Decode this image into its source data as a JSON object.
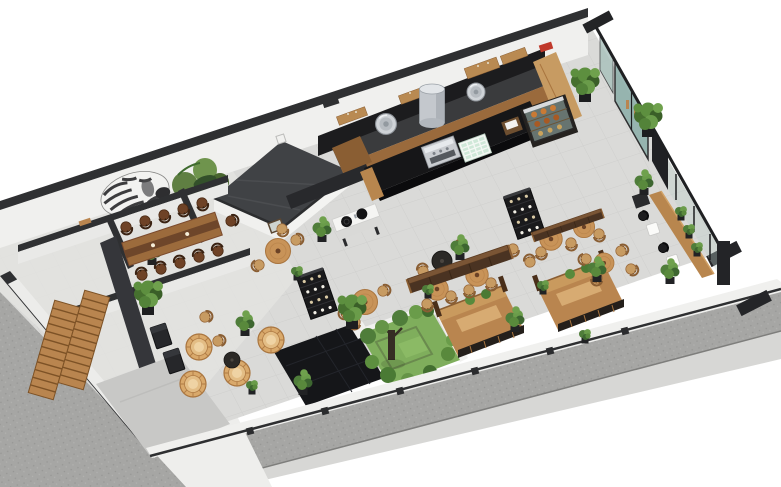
{
  "meta": {
    "title": "3D isometric floor-plan render of a cafe restaurant interior with kitchen, bar, dining hall, booths and street sidewalk"
  },
  "palette": {
    "bg": "#ffffff",
    "pavement": "#a6a6a4",
    "walkway": "#d7d7d5",
    "wedge": "#eeeeec",
    "floor": "#dadad8",
    "annexFloor": "#e3e3e1",
    "wallDark": "#2f3032",
    "wallFace": "#f0f0ee",
    "platform": "#404245",
    "blackFloor": "#151619",
    "grass": "#7fae5c",
    "glass": "#8fb0ab",
    "kitchenBlack": "#1c1c1e",
    "counterDark": "#3a3b3d",
    "woodLight": "#c79b62",
    "woodMid": "#9a6a3c",
    "islandBlack": "#161618",
    "signRed": "#c0392b",
    "roofGray": "#c8c8c6",
    "steel": "#c4c8cd",
    "mintTray": "#cfe8d8",
    "pastryOrange": "#c97a35",
    "plantGreen": "#4f7d3a",
    "benchBrown": "#4a3322"
  },
  "labels": {
    "scene": "3D cafe floor plan render, isometric view",
    "kitchen": "Open kitchen line with hoods and steel equipment",
    "bar": "Bar island with espresso machine, cup tray and register",
    "pastry": "Glass pastry display case",
    "communal": "Long communal wood table with dark chairs",
    "platform": "Dark raised platform room",
    "stairs": "Staircase annex with twin wood stair flights",
    "courtyard": "Inner courtyard garden with tree and black tiled patio",
    "entrance": "Glazed entrance doors",
    "sidewalk": "Street sidewalk pavement",
    "windowBar": "Window-side wood bar with black stools",
    "boothPods": "Wood partition booth pods along street wall",
    "lounge": "Rattan lounge chairs corner",
    "murals": "Zebra and jungle wall murals"
  },
  "furniture": [
    {
      "t": "chairD",
      "x": 126,
      "y": 227,
      "r": 162
    },
    {
      "t": "chairD",
      "x": 145,
      "y": 221,
      "r": 162
    },
    {
      "t": "chairD",
      "x": 164,
      "y": 215,
      "r": 162
    },
    {
      "t": "chairD",
      "x": 183,
      "y": 209,
      "r": 162
    },
    {
      "t": "chairD",
      "x": 202,
      "y": 203,
      "r": 162
    },
    {
      "t": "chairD",
      "x": 142,
      "y": 275,
      "r": -18
    },
    {
      "t": "chairD",
      "x": 161,
      "y": 269,
      "r": -18
    },
    {
      "t": "chairD",
      "x": 180,
      "y": 263,
      "r": -18
    },
    {
      "t": "chairD",
      "x": 199,
      "y": 257,
      "r": -18
    },
    {
      "t": "chairD",
      "x": 218,
      "y": 251,
      "r": -18
    },
    {
      "t": "chairD",
      "x": 231,
      "y": 221,
      "r": 72
    },
    {
      "t": "tableR",
      "x": 278,
      "y": 251,
      "r": 0
    },
    {
      "t": "chairW",
      "x": 259,
      "y": 265,
      "r": -110
    },
    {
      "t": "chairW",
      "x": 296,
      "y": 240,
      "r": 70
    },
    {
      "t": "chairW",
      "x": 282,
      "y": 229,
      "r": 160
    },
    {
      "t": "tableR",
      "x": 365,
      "y": 302,
      "r": 0
    },
    {
      "t": "chairW",
      "x": 346,
      "y": 313,
      "r": -110
    },
    {
      "t": "chairW",
      "x": 383,
      "y": 291,
      "r": 70
    },
    {
      "t": "chairW",
      "x": 355,
      "y": 322,
      "r": -170
    },
    {
      "t": "tableR",
      "x": 437,
      "y": 289,
      "r": 0,
      "s": 0.9
    },
    {
      "t": "tableR",
      "x": 477,
      "y": 275,
      "r": 0,
      "s": 0.9
    },
    {
      "t": "chairW",
      "x": 427,
      "y": 304,
      "r": 170
    },
    {
      "t": "chairW",
      "x": 451,
      "y": 296,
      "r": 170
    },
    {
      "t": "chairW",
      "x": 469,
      "y": 290,
      "r": 170
    },
    {
      "t": "chairW",
      "x": 491,
      "y": 283,
      "r": 170
    },
    {
      "t": "tableRD",
      "x": 442,
      "y": 261,
      "r": 0
    },
    {
      "t": "chairW",
      "x": 423,
      "y": 271,
      "r": -15
    },
    {
      "t": "chairW",
      "x": 461,
      "y": 247,
      "r": -15
    },
    {
      "t": "tableR",
      "x": 551,
      "y": 239,
      "r": 0,
      "s": 0.9
    },
    {
      "t": "tableR",
      "x": 584,
      "y": 227,
      "r": 0,
      "s": 0.85
    },
    {
      "t": "chairW",
      "x": 541,
      "y": 252,
      "r": 170
    },
    {
      "t": "chairW",
      "x": 571,
      "y": 243,
      "r": 170
    },
    {
      "t": "chairW",
      "x": 599,
      "y": 234,
      "r": 170
    },
    {
      "t": "chairW",
      "x": 513,
      "y": 249,
      "r": 170
    },
    {
      "t": "chairW",
      "x": 530,
      "y": 262,
      "r": -15
    },
    {
      "t": "tableR",
      "x": 604,
      "y": 263,
      "r": 0,
      "s": 0.8
    },
    {
      "t": "chairW",
      "x": 586,
      "y": 259,
      "r": -100
    },
    {
      "t": "chairW",
      "x": 621,
      "y": 251,
      "r": 60
    },
    {
      "t": "chairW",
      "x": 597,
      "y": 278,
      "r": -170
    },
    {
      "t": "chairW",
      "x": 631,
      "y": 269,
      "r": 120
    },
    {
      "t": "tableDark",
      "x": 161,
      "y": 336,
      "r": -18
    },
    {
      "t": "tableDark",
      "x": 174,
      "y": 361,
      "r": -18
    },
    {
      "t": "chairW",
      "x": 205,
      "y": 317,
      "r": 75
    },
    {
      "t": "chairW",
      "x": 218,
      "y": 341,
      "r": 75
    },
    {
      "t": "rattan",
      "x": 193,
      "y": 384
    },
    {
      "t": "rattan",
      "x": 237,
      "y": 373
    },
    {
      "t": "rattan",
      "x": 199,
      "y": 347
    },
    {
      "t": "rattan",
      "x": 271,
      "y": 340
    },
    {
      "t": "tableRD",
      "x": 232,
      "y": 360,
      "r": 0,
      "s": 0.8
    },
    {
      "t": "chairB",
      "x": 643,
      "y": 216,
      "r": 65
    },
    {
      "t": "chairB",
      "x": 663,
      "y": 248,
      "r": 65
    },
    {
      "t": "tableW",
      "x": 653,
      "y": 229,
      "r": -18
    },
    {
      "t": "tableW",
      "x": 673,
      "y": 261,
      "r": -18
    },
    {
      "t": "shelfTall",
      "x": 524,
      "y": 214,
      "r": -19
    },
    {
      "t": "shelfTall",
      "x": 317,
      "y": 294,
      "r": -19
    },
    {
      "t": "bench",
      "x": 460,
      "y": 270,
      "r": -18.7,
      "s": 1.05
    },
    {
      "t": "bench",
      "x": 568,
      "y": 226,
      "r": -19,
      "s": 0.72
    },
    {
      "t": "stairs",
      "x": 54,
      "y": 350,
      "r": 16
    },
    {
      "t": "stairs",
      "x": 84,
      "y": 340,
      "r": 16
    },
    {
      "t": "potS",
      "x": 386,
      "y": 124,
      "r": 0,
      "s": 1.1
    },
    {
      "t": "potS",
      "x": 476,
      "y": 92,
      "r": 0,
      "s": 0.95
    },
    {
      "t": "hood",
      "x": 432,
      "y": 106,
      "r": 0
    },
    {
      "t": "plantL",
      "x": 585,
      "y": 85
    },
    {
      "t": "plantL",
      "x": 648,
      "y": 120
    },
    {
      "t": "plantM",
      "x": 644,
      "y": 184
    },
    {
      "t": "plantM",
      "x": 597,
      "y": 271
    },
    {
      "t": "plantM",
      "x": 670,
      "y": 273
    },
    {
      "t": "plantS",
      "x": 681,
      "y": 213
    },
    {
      "t": "plantS",
      "x": 689,
      "y": 231
    },
    {
      "t": "plantS",
      "x": 697,
      "y": 249
    },
    {
      "t": "plantM",
      "x": 322,
      "y": 231
    },
    {
      "t": "plantL",
      "x": 148,
      "y": 298
    },
    {
      "t": "plantM",
      "x": 152,
      "y": 254
    },
    {
      "t": "plantM",
      "x": 245,
      "y": 325
    },
    {
      "t": "plantS",
      "x": 252,
      "y": 387
    },
    {
      "t": "plantM",
      "x": 303,
      "y": 384
    },
    {
      "t": "plantS",
      "x": 297,
      "y": 273
    },
    {
      "t": "plantM",
      "x": 460,
      "y": 249
    },
    {
      "t": "plantS",
      "x": 428,
      "y": 291
    },
    {
      "t": "plantM",
      "x": 515,
      "y": 321
    },
    {
      "t": "plantL",
      "x": 352,
      "y": 312
    },
    {
      "t": "plantS",
      "x": 585,
      "y": 336
    },
    {
      "t": "plantS",
      "x": 543,
      "y": 287
    }
  ]
}
